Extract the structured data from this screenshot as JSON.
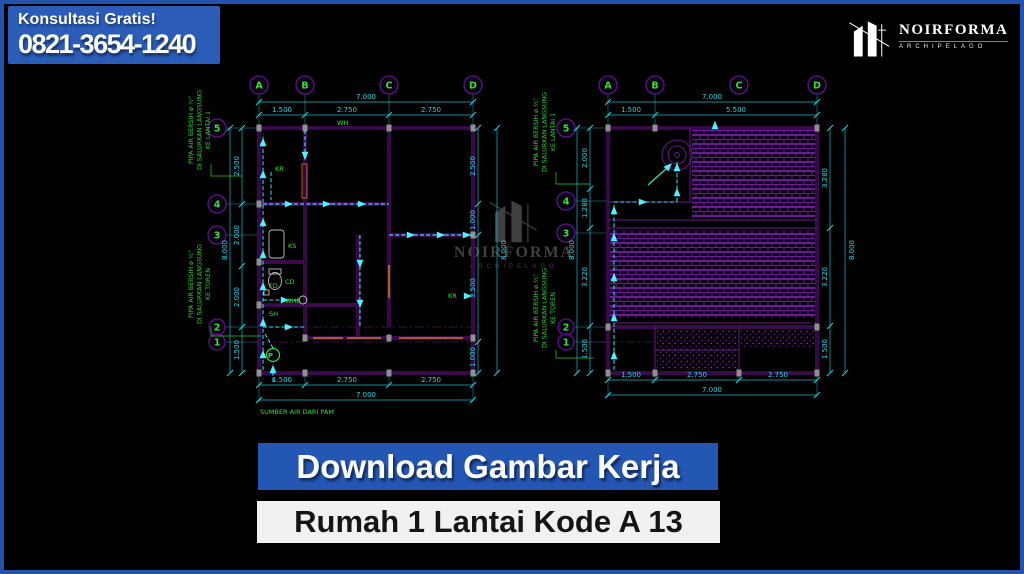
{
  "frame": {
    "border_color": "#2453ad",
    "background": "#000000"
  },
  "contact_badge": {
    "heading": "Konsultasi Gratis!",
    "phone": "0821-3654-1240",
    "bg": "#2a5cb8"
  },
  "brand": {
    "name": "NOIRFORMA",
    "subtitle": "ARCHIPELAGO"
  },
  "watermark": {
    "name": "NOIRFORMA",
    "subtitle": "ARCHIPELAGO"
  },
  "banners": {
    "download": {
      "label": "Download Gambar Kerja",
      "bg": "#2456b4",
      "fg": "#ffffff"
    },
    "product": {
      "label": "Rumah 1 Lantai Kode A 13",
      "bg": "#f1f1f1",
      "fg": "#141414"
    }
  },
  "pipe_notes": {
    "to_floor": {
      "l1": "PIPA AIR BERSIH ø ½\"",
      "l2": "DI SALURKAN LANGSUNG",
      "l3": "KE LANTAI 1"
    },
    "to_tank": {
      "l1": "PIPA AIR BERSIH ø ½\"",
      "l2": "DI SALURKAN LANGSUNG",
      "l3": "KE TOREN"
    }
  },
  "left_plan": {
    "grid_cols": [
      "A",
      "B",
      "C",
      "D"
    ],
    "grid_rows": [
      "5",
      "4",
      "3",
      "2",
      "1"
    ],
    "dim_overall_width": "7.000",
    "dims_top": [
      "1.500",
      "2.750",
      "2.750"
    ],
    "dims_bottom": [
      "1.500",
      "2.750",
      "2.750"
    ],
    "dim_overall_bottom": "7.000",
    "dims_left": [
      "2.500",
      "2.000",
      "2.000",
      "1.500"
    ],
    "dim_overall_left": "8.000",
    "dims_right": [
      "2.500",
      "1.000",
      "3.500",
      "1.000"
    ],
    "dim_overall_right": "8.000",
    "labels": {
      "wh": "WH",
      "kr": "KR",
      "ks": "KS",
      "cd": "CD",
      "fd": "FD",
      "whb": "WHB",
      "sh": "SH",
      "pump": "P",
      "kr2": "KR",
      "source": "SUMBER AIR DARI PAM"
    }
  },
  "right_plan": {
    "grid_cols": [
      "A",
      "B",
      "C",
      "D"
    ],
    "grid_rows": [
      "5",
      "4",
      "3",
      "2",
      "1"
    ],
    "dim_overall_width": "7.000",
    "dims_top": [
      "1.500",
      "5.500"
    ],
    "dims_bottom": [
      "1.500",
      "2.750",
      "2.750"
    ],
    "dim_overall_bottom": "7.000",
    "dims_left": [
      "2.000",
      "1.280",
      "3.220",
      "1.500"
    ],
    "dim_overall_left": "8.000",
    "dims_right": [
      "3.280",
      "3.220",
      "1.500"
    ],
    "dim_overall_right": "8.000"
  },
  "colors": {
    "wall": "#6e1390",
    "dimension": "#1fd9ea",
    "label_green": "#2ee22e",
    "pipe_cyan": "#2fe9ff",
    "window_orange": "#b8621c",
    "column_gray": "#8f8f8f"
  }
}
